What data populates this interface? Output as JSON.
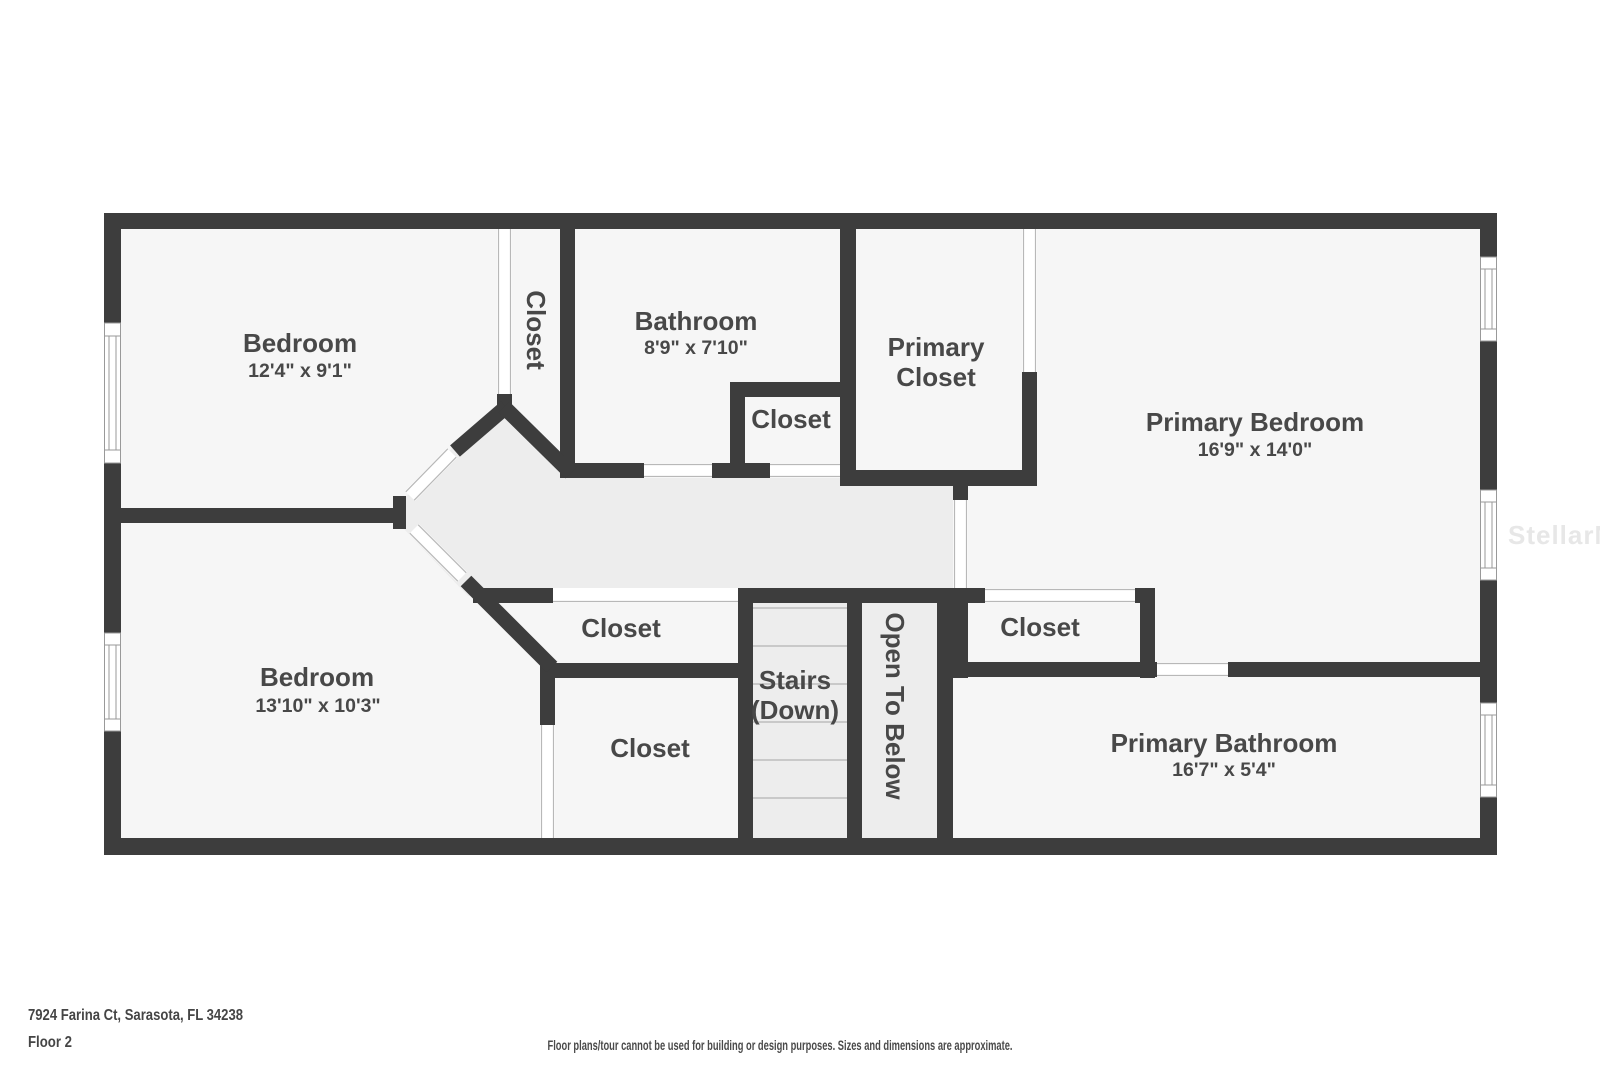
{
  "plan_title": "Floor plan, second floor",
  "rooms": {
    "bedroom_top": {
      "name": "Bedroom",
      "dims": "12'4\" x 9'1\""
    },
    "closet_top": {
      "name": "Closet"
    },
    "bathroom": {
      "name": "Bathroom",
      "dims": "8'9\" x 7'10\""
    },
    "closet_bath": {
      "name": "Closet"
    },
    "primary_closet": {
      "line1": "Primary",
      "line2": "Closet"
    },
    "primary_bedroom": {
      "name": "Primary Bedroom",
      "dims": "16'9\" x 14'0\""
    },
    "closet_hall_upper": {
      "name": "Closet"
    },
    "closet_hall_lower": {
      "name": "Closet"
    },
    "stairs": {
      "line1": "Stairs",
      "line2": "(Down)"
    },
    "open_to_below": {
      "name": "Open To Below"
    },
    "closet_primary_hall": {
      "name": "Closet"
    },
    "bedroom_bottom": {
      "name": "Bedroom",
      "dims": "13'10\" x 10'3\""
    },
    "primary_bathroom": {
      "name": "Primary Bathroom",
      "dims": "16'7\" x 5'4\""
    }
  },
  "footer": {
    "address": "7924 Farina Ct, Sarasota, FL 34238",
    "floor": "Floor 2",
    "disclaimer": "Floor plans/tour cannot be used for building or design purposes. Sizes and dimensions are approximate."
  },
  "watermark": "StellarMLS",
  "colors": {
    "wall": "#3d3d3d",
    "room_fill": "#f6f6f6",
    "hall_fill": "#ededed",
    "label_text": "#484848",
    "window_line": "#999999",
    "door_line": "#b8b8b8",
    "step_line": "#c9c9c9",
    "watermark": "#e7e7e7",
    "background": "#ffffff"
  }
}
